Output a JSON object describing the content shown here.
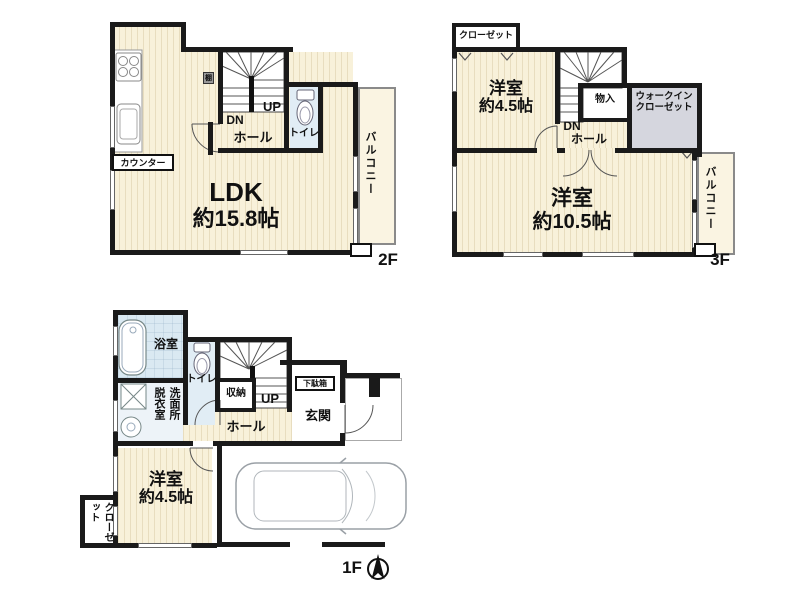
{
  "colors": {
    "wall": "#1a1a1a",
    "floor_cream": "#f8f1da",
    "floor_wet": "#dae9f2",
    "floor_walkin_closet": "#d5d6de",
    "balcony_outline": "#8a8a8a",
    "background": "#ffffff"
  },
  "floor2": {
    "label": "2F",
    "ldk_name": "LDK",
    "ldk_size": "約15.8帖",
    "counter": "カウンター",
    "dn": "DN",
    "up": "UP",
    "hall": "ホール",
    "toilet": "トイレ",
    "balcony": "バルコニー",
    "shelf": "棚"
  },
  "floor3": {
    "label": "3F",
    "closet": "クローゼット",
    "room_small_name": "洋室",
    "room_small_size": "約4.5帖",
    "dn": "DN",
    "hall": "ホール",
    "storage": "物入",
    "wic_line1": "ウォークイン",
    "wic_line2": "クローゼット",
    "room_large_name": "洋室",
    "room_large_size": "約10.5帖",
    "balcony": "バルコニー"
  },
  "floor1": {
    "label": "1F",
    "bath": "浴室",
    "toilet": "トイレ",
    "washroom_col_right": "洗面所",
    "washroom_col_left": "脱衣室",
    "storage": "収納",
    "up": "UP",
    "hall": "ホール",
    "shoe_box": "下駄箱",
    "entrance": "玄関",
    "room_name": "洋室",
    "room_size": "約4.5帖",
    "closet": "クローゼット"
  }
}
